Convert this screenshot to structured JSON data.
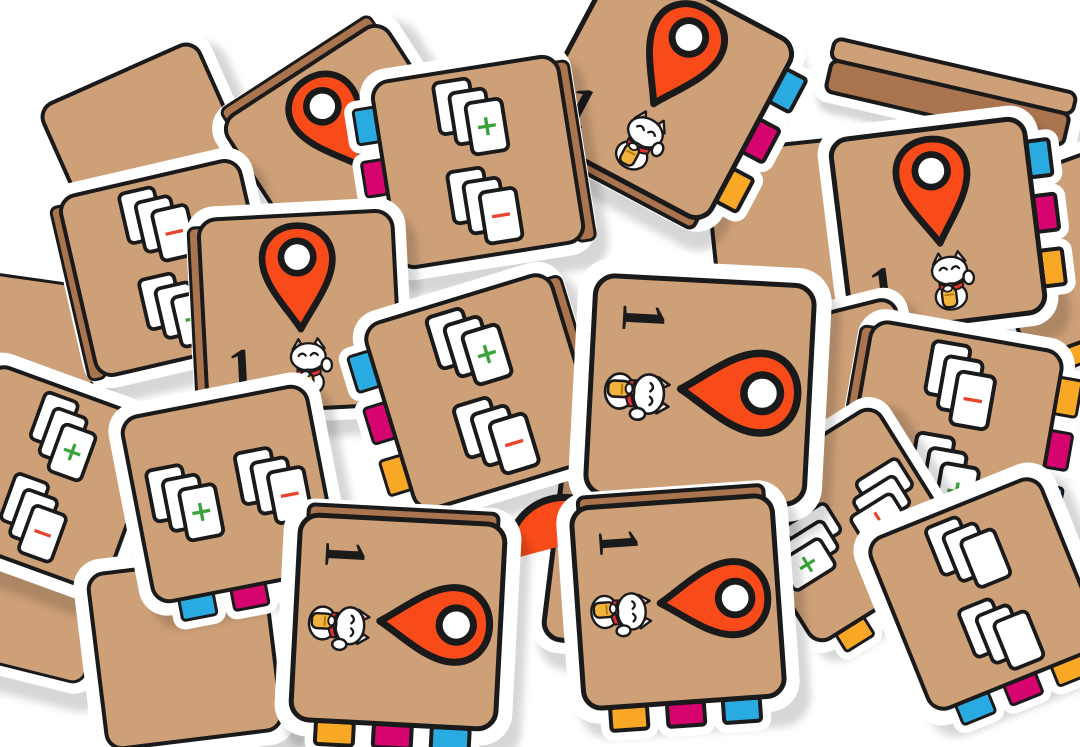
{
  "scene": {
    "description": "Pile of square cardboard game tiles scattered on a white background. Two tile designs: an orange map-pin tile with the number 1 and a lucky-cat sticker, and a card-stacks tile with a green plus stack and a red minus stack. Each tile has a tan face, black hand-drawn border, white die-cut rim, and three small colored connector tabs (blue, magenta, yellow) on one edge.",
    "background": "#ffffff"
  },
  "palette": {
    "face": "#CEA078",
    "depth": "#A9744E",
    "outline": "#1A1A1A",
    "white": "#FFFFFF",
    "pin": "#F94B1A",
    "blue": "#29ABE2",
    "magenta": "#D6046F",
    "yellow": "#F9A825",
    "plus_green": "#3AA23A",
    "minus_red": "#E8432B",
    "cat_red": "#E03030",
    "coin_gold": "#F2B33D",
    "shadow": "rgba(0,0,0,0.16)"
  },
  "symbols": {
    "plus": "+",
    "minus": "−",
    "number": "1"
  },
  "icons": [
    "map-pin-icon",
    "lucky-cat-icon",
    "card-stack-icon",
    "edge-tab"
  ],
  "tiles": [
    {
      "id": "slab-top-right",
      "type": "slab",
      "x": 950,
      "y": 92,
      "w": 252,
      "h": 58,
      "rot": 13
    },
    {
      "id": "filler-top-left",
      "type": "blank",
      "x": 150,
      "y": 152,
      "size": 175,
      "rot": -24,
      "wb": 11
    },
    {
      "id": "filler-left-edge",
      "type": "blank",
      "x": 22,
      "y": 352,
      "size": 150,
      "rot": 8,
      "wb": 10
    },
    {
      "id": "pin-upper-left",
      "type": "pin",
      "x": 352,
      "y": 152,
      "size": 196,
      "rot": -33,
      "wb": 11,
      "contentRot": 0,
      "depth": "top",
      "number": "1"
    },
    {
      "id": "filler-behind-right",
      "type": "blank",
      "x": 802,
      "y": 232,
      "size": 182,
      "rot": -6,
      "wb": 10,
      "tabs": {
        "edge": "right",
        "colors": [
          "blue",
          "magenta",
          "yellow"
        ]
      }
    },
    {
      "id": "pin-top-center",
      "type": "pin",
      "x": 662,
      "y": 88,
      "size": 206,
      "rot": 28,
      "wb": 11,
      "contentRot": 0,
      "depth": "bottom",
      "number": "1",
      "tabs": {
        "edge": "right",
        "colors": [
          "blue",
          "magenta",
          "yellow"
        ]
      }
    },
    {
      "id": "filler-right-edge",
      "type": "blank",
      "x": 1082,
      "y": 248,
      "size": 180,
      "rot": -20,
      "wb": 11,
      "tabs": {
        "edge": "bottom",
        "colors": [
          "yellow",
          "magenta",
          "blue"
        ]
      }
    },
    {
      "id": "pin-top-right",
      "type": "pin",
      "x": 938,
      "y": 226,
      "size": 200,
      "rot": -7,
      "wb": 11,
      "contentRot": 0,
      "number": "1",
      "tabs": {
        "edge": "right",
        "colors": [
          "blue",
          "magenta",
          "yellow"
        ]
      }
    },
    {
      "id": "cards-left",
      "type": "cards-v",
      "x": 168,
      "y": 268,
      "size": 188,
      "rot": -13,
      "wb": 11,
      "stacks": [
        "minus",
        "plus"
      ],
      "depth": "left"
    },
    {
      "id": "filler-mid-right",
      "type": "blank",
      "x": 830,
      "y": 400,
      "size": 175,
      "rot": -14,
      "wb": 10
    },
    {
      "id": "cards-top-center",
      "type": "cards-v",
      "x": 478,
      "y": 162,
      "size": 192,
      "rot": -9,
      "wb": 11,
      "stacks": [
        "plus",
        "minus"
      ],
      "depth": "right",
      "tabs": {
        "edge": "left",
        "colors": [
          "blue",
          "magenta",
          "yellow"
        ]
      }
    },
    {
      "id": "pin-center-left",
      "type": "pin",
      "x": 300,
      "y": 312,
      "size": 198,
      "rot": -3,
      "wb": 11,
      "contentRot": 0,
      "depth": "left",
      "number": "1"
    },
    {
      "id": "cards-right",
      "type": "cards-v",
      "x": 952,
      "y": 432,
      "size": 198,
      "rot": 10,
      "wb": 11,
      "stacks": [
        "minus",
        "plus"
      ],
      "depth": "left",
      "tabs": {
        "edge": "right",
        "colors": [
          "yellow",
          "magenta",
          "blue"
        ]
      }
    },
    {
      "id": "filler-bottom-left-corner",
      "type": "blank",
      "x": 30,
      "y": 598,
      "size": 145,
      "rot": 14,
      "wb": 10
    },
    {
      "id": "pin-under-center",
      "type": "pin",
      "x": 652,
      "y": 552,
      "size": 202,
      "rot": 7,
      "wb": 11,
      "contentRot": 90,
      "depth": "top",
      "number": "1",
      "tabs": {
        "edge": "right",
        "colors": [
          "blue",
          "magenta",
          "yellow"
        ]
      }
    },
    {
      "id": "cards-hidden-right",
      "type": "cards-v",
      "x": 845,
      "y": 525,
      "size": 180,
      "rot": -32,
      "wb": 10,
      "stacks": [
        "minus",
        "plus"
      ],
      "contentRot": 90,
      "tabs": {
        "edge": "bottom",
        "colors": [
          "yellow",
          "magenta",
          "blue"
        ]
      }
    },
    {
      "id": "cards-back-bottom-right",
      "type": "cards-back",
      "x": 985,
      "y": 594,
      "size": 188,
      "rot": -22,
      "wb": 14,
      "stacks": [
        "",
        ""
      ],
      "tabs": {
        "edge": "bottom",
        "colors": [
          "blue",
          "magenta",
          "yellow"
        ]
      }
    },
    {
      "id": "cards-far-left",
      "type": "cards-v",
      "x": 48,
      "y": 478,
      "size": 184,
      "rot": 20,
      "wb": 12,
      "stacks": [
        "plus",
        "minus"
      ],
      "tabs": {
        "edge": "left",
        "colors": [
          "blue",
          "magenta",
          "yellow"
        ]
      }
    },
    {
      "id": "cards-center",
      "type": "cards-v",
      "x": 483,
      "y": 392,
      "size": 198,
      "rot": -17,
      "wb": 11,
      "stacks": [
        "plus",
        "minus"
      ],
      "depth": "right",
      "tabs": {
        "edge": "left",
        "colors": [
          "blue",
          "magenta",
          "yellow"
        ]
      }
    },
    {
      "id": "filler-bottom-left",
      "type": "blank",
      "x": 185,
      "y": 652,
      "size": 180,
      "rot": -7,
      "wb": 13
    },
    {
      "id": "pin-peek",
      "type": "pin-peek",
      "x": 552,
      "y": 512,
      "w": 95,
      "h": 70,
      "rot": -15
    },
    {
      "id": "cards-bottom-left",
      "type": "cards-h",
      "x": 230,
      "y": 494,
      "size": 192,
      "rot": -11,
      "wb": 12,
      "stacks": [
        "plus",
        "minus"
      ],
      "tabs": {
        "edge": "bottom",
        "colors": [
          "blue",
          "magenta",
          "yellow"
        ]
      }
    },
    {
      "id": "pin-center-front",
      "type": "pin",
      "x": 700,
      "y": 390,
      "size": 224,
      "rot": 3,
      "wb": 15,
      "contentRot": 90,
      "number": "1",
      "tabs": {
        "edge": "bottom",
        "colors": [
          "yellow",
          "magenta",
          "blue"
        ]
      }
    },
    {
      "id": "pin-bottom-right",
      "type": "pin",
      "x": 678,
      "y": 602,
      "size": 206,
      "rot": -4,
      "wb": 13,
      "contentRot": 90,
      "depth": "top",
      "number": "1",
      "tabs": {
        "edge": "bottom",
        "colors": [
          "yellow",
          "magenta",
          "blue"
        ]
      }
    },
    {
      "id": "pin-bottom-front",
      "type": "pin",
      "x": 398,
      "y": 622,
      "size": 210,
      "rot": 3,
      "wb": 14,
      "contentRot": 90,
      "depth": "top",
      "number": "1",
      "tabs": {
        "edge": "bottom",
        "colors": [
          "yellow",
          "magenta",
          "blue"
        ]
      }
    }
  ]
}
